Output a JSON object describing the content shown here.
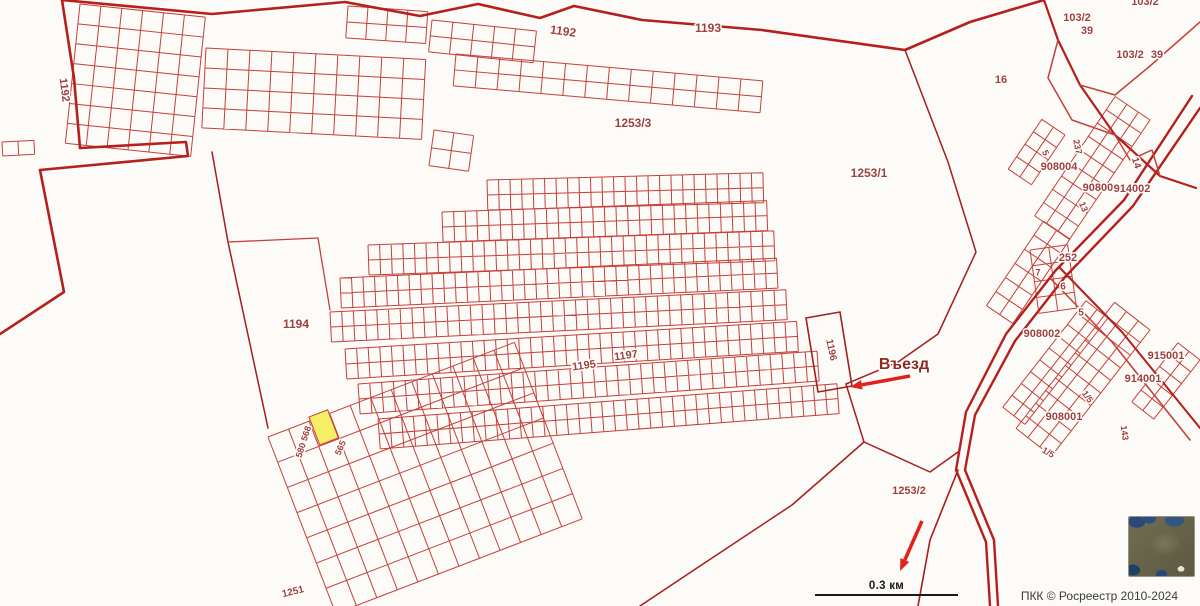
{
  "attribution": "ПКК © Росреестр 2010-2024",
  "scale_bar": {
    "label": "0.3 км"
  },
  "map": {
    "background": "#fcfbf8",
    "colors": {
      "parcel": "#c4403a",
      "thick": "#b5201d",
      "thin_boundary": "#a51d1d",
      "label": "#9f403b",
      "arrow": "#e3201b",
      "highlight_fill": "#f5ee67",
      "entrance_text": "#8a2b1c"
    },
    "grids": [
      {
        "x": 80,
        "y": 4,
        "a": 6,
        "cols": 6,
        "rows": 7,
        "cw": 21,
        "ch": 20
      },
      {
        "x": 206,
        "y": 48,
        "a": 3,
        "cols": 10,
        "rows": 4,
        "cw": 22,
        "ch": 20
      },
      {
        "x": 348,
        "y": 6,
        "a": 4,
        "cols": 4,
        "rows": 2,
        "cw": 20,
        "ch": 16
      },
      {
        "x": 432,
        "y": 20,
        "a": 6,
        "cols": 5,
        "rows": 2,
        "cw": 21,
        "ch": 16
      },
      {
        "x": 456,
        "y": 54,
        "a": 5,
        "cols": 14,
        "rows": 2,
        "cw": 22,
        "ch": 16
      },
      {
        "x": 434,
        "y": 130,
        "a": 8,
        "cols": 2,
        "rows": 2,
        "cw": 20,
        "ch": 18
      },
      {
        "x": 2,
        "y": 142,
        "a": -3,
        "cols": 2,
        "rows": 1,
        "cw": 16,
        "ch": 14
      },
      {
        "x": 487,
        "y": 180,
        "a": -1.5,
        "cols": 24,
        "rows": 2,
        "cw": 11.5,
        "ch": 15
      },
      {
        "x": 442,
        "y": 212,
        "a": -2,
        "cols": 28,
        "rows": 2,
        "cw": 11.6,
        "ch": 15
      },
      {
        "x": 368,
        "y": 245,
        "a": -2,
        "cols": 35,
        "rows": 2,
        "cw": 11.6,
        "ch": 15
      },
      {
        "x": 340,
        "y": 278,
        "a": -2.6,
        "cols": 38,
        "rows": 2,
        "cw": 11.5,
        "ch": 15
      },
      {
        "x": 330,
        "y": 312,
        "a": -2.8,
        "cols": 39,
        "rows": 2,
        "cw": 11.7,
        "ch": 15
      },
      {
        "x": 345,
        "y": 349,
        "a": -3.5,
        "cols": 39,
        "rows": 2,
        "cw": 11.6,
        "ch": 15
      },
      {
        "x": 358,
        "y": 384,
        "a": -4.1,
        "cols": 39,
        "rows": 2,
        "cw": 11.8,
        "ch": 15
      },
      {
        "x": 378,
        "y": 419,
        "a": -4.4,
        "cols": 39,
        "rows": 2,
        "cw": 11.8,
        "ch": 15
      },
      {
        "x": 268,
        "y": 437,
        "a": -21,
        "cols": 12,
        "rows": 7,
        "cw": 22,
        "ch": 27
      },
      {
        "x": 1150,
        "y": 120,
        "a": 124,
        "cols": 9,
        "rows": 3,
        "cw": 16,
        "ch": 14
      },
      {
        "x": 1065,
        "y": 135,
        "a": 124,
        "cols": 4,
        "rows": 2,
        "cw": 15,
        "ch": 14
      },
      {
        "x": 1070,
        "y": 239,
        "a": 124,
        "cols": 6,
        "rows": 2,
        "cw": 17,
        "ch": 16
      },
      {
        "x": 1030,
        "y": 250,
        "a": -8,
        "cols": 2,
        "rows": 4,
        "cw": 19,
        "ch": 16
      },
      {
        "x": 1150,
        "y": 330,
        "a": 128,
        "cols": 10,
        "rows": 3,
        "cw": 16,
        "ch": 15
      },
      {
        "x": 1108,
        "y": 318,
        "a": 128,
        "cols": 9,
        "rows": 2,
        "cw": 15,
        "ch": 14
      },
      {
        "x": 1200,
        "y": 360,
        "a": 128,
        "cols": 5,
        "rows": 2,
        "cw": 15,
        "ch": 14
      }
    ],
    "polylines": [
      {
        "n": "quarter-boundary-top",
        "pts": "62,0 212,14 345,2 420,16 478,4 540,18 574,6 642,20 762,30 905,50 970,22 1044,0",
        "w": 2.6,
        "k": "thick"
      },
      {
        "n": "quarter-boundary-left",
        "pts": "62,0 74,78 80,148",
        "w": 2.6,
        "k": "thick"
      },
      {
        "n": "quarter-boundary-left-jog",
        "pts": "80,148 186,142 188,156 40,170",
        "w": 2.6,
        "k": "thick"
      },
      {
        "n": "quarter-boundary-left-lower",
        "pts": "40,170 64,292 0,334",
        "w": 2.6,
        "k": "thick"
      },
      {
        "n": "road-edge-a",
        "pts": "1192,96 1124,200 1056,270 1006,334 966,412 956,470 986,542 990,606",
        "w": 2.4,
        "k": "thick"
      },
      {
        "n": "road-edge-b",
        "pts": "1200,108 1133,206 1065,277 1015,341 975,415 965,470 994,540 998,606",
        "w": 2.4,
        "k": "thick"
      },
      {
        "n": "road-branch-a",
        "pts": "1060,268 1122,332 1200,428",
        "w": 2,
        "k": "thick"
      },
      {
        "n": "road-branch-b",
        "pts": "1050,278 1112,342 1190,440",
        "w": 1.6,
        "k": "parcel"
      },
      {
        "n": "boundary-parcel-16",
        "pts": "905,50 948,162 976,252 938,334 898,362 846,384",
        "w": 1.5,
        "k": "thin_boundary"
      },
      {
        "n": "boundary-1253-2-north",
        "pts": "846,384 864,442 930,472 958,452",
        "w": 1.5,
        "k": "thin_boundary"
      },
      {
        "n": "boundary-1253-2-west",
        "pts": "864,442 792,505 700,566 640,606",
        "w": 1.5,
        "k": "thin_boundary"
      },
      {
        "n": "road-tail",
        "pts": "958,470 930,540 918,606",
        "w": 1.6,
        "k": "thin_boundary"
      },
      {
        "n": "wedge-103-2-a",
        "pts": "1044,0 1058,40 1080,85 1115,135 1160,176 1196,188",
        "w": 2.2,
        "k": "thick"
      },
      {
        "n": "wedge-103-2-b",
        "pts": "1058,40 1048,78 1072,120 1115,135",
        "w": 1.5,
        "k": "parcel"
      },
      {
        "n": "wedge-103-2-c",
        "pts": "1200,22 1150,66 1115,95 1080,85",
        "w": 1.5,
        "k": "parcel"
      },
      {
        "n": "wedge-103-2-d",
        "pts": "1115,135 1130,160 1152,150 1160,176",
        "w": 1.5,
        "k": "parcel"
      },
      {
        "n": "boundary-1194-west",
        "pts": "212,152 228,242 268,428",
        "w": 1.5,
        "k": "thin_boundary"
      },
      {
        "n": "boundary-1194-east",
        "pts": "228,242 318,238 330,310",
        "w": 1.3,
        "k": "parcel"
      }
    ],
    "polygons": [
      {
        "n": "parcel-1196",
        "pts": "806,318 840,312 852,386 818,392",
        "w": 1.6,
        "k": "thin_boundary"
      }
    ],
    "highlight_parcel": {
      "x": 309,
      "y": 417,
      "w": 20,
      "h": 30,
      "a": -21
    },
    "labels": [
      {
        "t": "1192",
        "x": 64,
        "y": 90,
        "r": 83,
        "s": 11
      },
      {
        "t": "1192",
        "x": 563,
        "y": 32,
        "r": 8,
        "s": 12
      },
      {
        "t": "1193",
        "x": 708,
        "y": 29,
        "r": 0,
        "s": 12
      },
      {
        "t": "1253/3",
        "x": 633,
        "y": 124,
        "r": 0,
        "s": 12
      },
      {
        "t": "1253/1",
        "x": 869,
        "y": 174,
        "r": 0,
        "s": 12
      },
      {
        "t": "16",
        "x": 1001,
        "y": 80,
        "r": 0,
        "s": 11
      },
      {
        "t": "103/2",
        "x": 1077,
        "y": 18,
        "r": 0,
        "s": 11
      },
      {
        "t": "39",
        "x": 1087,
        "y": 31,
        "r": 0,
        "s": 11
      },
      {
        "t": "103/2",
        "x": 1130,
        "y": 55,
        "r": 0,
        "s": 11
      },
      {
        "t": "39",
        "x": 1157,
        "y": 55,
        "r": 0,
        "s": 11
      },
      {
        "t": "103/2",
        "x": 1145,
        "y": 2,
        "r": 0,
        "s": 11
      },
      {
        "t": "908004",
        "x": 1059,
        "y": 167,
        "r": 0,
        "s": 11
      },
      {
        "t": "908003",
        "x": 1101,
        "y": 188,
        "r": 0,
        "s": 11
      },
      {
        "t": "914002",
        "x": 1132,
        "y": 189,
        "r": 0,
        "s": 11
      },
      {
        "t": "237",
        "x": 1077,
        "y": 147,
        "r": 78,
        "s": 9
      },
      {
        "t": "5",
        "x": 1045,
        "y": 153,
        "r": 65,
        "s": 9
      },
      {
        "t": "14",
        "x": 1136,
        "y": 163,
        "r": 72,
        "s": 10
      },
      {
        "t": "13",
        "x": 1083,
        "y": 207,
        "r": 68,
        "s": 9
      },
      {
        "t": "252",
        "x": 1068,
        "y": 258,
        "r": 0,
        "s": 11
      },
      {
        "t": "7",
        "x": 1038,
        "y": 273,
        "r": 0,
        "s": 9
      },
      {
        "t": "6",
        "x": 1063,
        "y": 287,
        "r": 0,
        "s": 10
      },
      {
        "t": "5",
        "x": 1081,
        "y": 313,
        "r": 0,
        "s": 10
      },
      {
        "t": "908002",
        "x": 1042,
        "y": 334,
        "r": 0,
        "s": 11
      },
      {
        "t": "915001",
        "x": 1166,
        "y": 356,
        "r": 0,
        "s": 11
      },
      {
        "t": "914001",
        "x": 1143,
        "y": 379,
        "r": 0,
        "s": 11
      },
      {
        "t": "1/5",
        "x": 1087,
        "y": 397,
        "r": 55,
        "s": 9
      },
      {
        "t": "908001",
        "x": 1064,
        "y": 417,
        "r": 0,
        "s": 11
      },
      {
        "t": "143",
        "x": 1124,
        "y": 433,
        "r": 82,
        "s": 9
      },
      {
        "t": "1/5",
        "x": 1048,
        "y": 453,
        "r": 30,
        "s": 9
      },
      {
        "t": "1194",
        "x": 296,
        "y": 325,
        "r": 0,
        "s": 12
      },
      {
        "t": "1195",
        "x": 584,
        "y": 366,
        "r": -8,
        "s": 11
      },
      {
        "t": "1197",
        "x": 626,
        "y": 356,
        "r": -8,
        "s": 11
      },
      {
        "t": "1196",
        "x": 831,
        "y": 350,
        "r": 78,
        "s": 10
      },
      {
        "t": "Въезд",
        "x": 904,
        "y": 365,
        "r": 0,
        "s": 16,
        "c": "entrance_text"
      },
      {
        "t": "580 568",
        "x": 304,
        "y": 442,
        "r": -72,
        "s": 9
      },
      {
        "t": "565",
        "x": 341,
        "y": 448,
        "r": -66,
        "s": 9
      },
      {
        "t": "1251",
        "x": 293,
        "y": 592,
        "r": -14,
        "s": 10
      },
      {
        "t": "1253/2",
        "x": 909,
        "y": 491,
        "r": 0,
        "s": 11
      }
    ],
    "arrows": [
      {
        "n": "entrance-arrow",
        "x1": 910,
        "y1": 376,
        "x2": 850,
        "y2": 387,
        "w": 3.5
      },
      {
        "n": "direction-arrow",
        "x1": 922,
        "y1": 521,
        "x2": 900,
        "y2": 571,
        "w": 3.5
      }
    ]
  }
}
